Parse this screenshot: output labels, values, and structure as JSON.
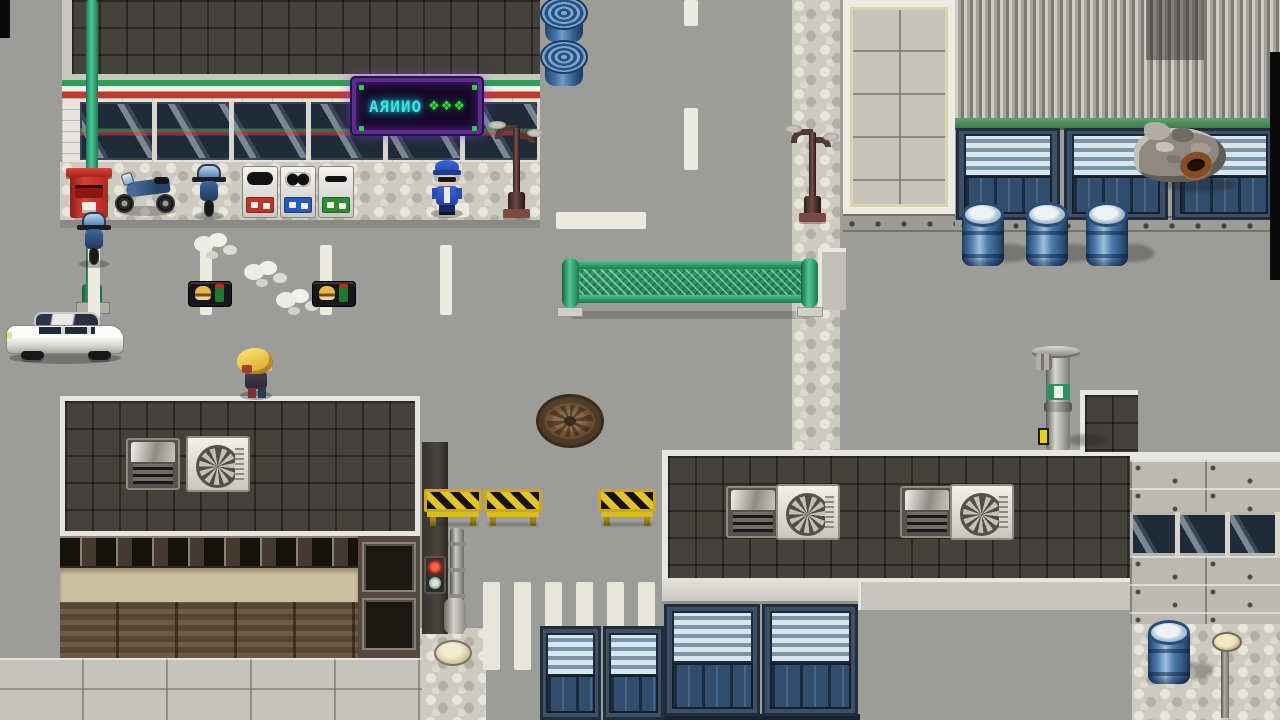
{
  "scene": {
    "label": "top-down city street with convenience store",
    "sign": {
      "text": "ONNRA",
      "symbols": "❖❖❖"
    }
  },
  "colors": {
    "road": "#9c9c98",
    "store_roof": "#45413d",
    "frame_light": "#e6e4de",
    "awning_green": "#2f9e57",
    "awning_red": "#c0392f",
    "brick_wall": "#e6e3dc",
    "window_glass": "#1f2b38",
    "neon_frame": "#5b2e8e",
    "neon_text": "#3ae4e4",
    "neon_symbols": "#34d83a",
    "pavement": "#cdcac2",
    "mailbox_red": "#c8322b",
    "motorcycle_blue": "#3a5a8a",
    "officer_blue": "#2d5ac8",
    "player_hair": "#e8c44a",
    "car_white": "#e9e9e7",
    "fence_green": "#2f9e6a",
    "manhole_brown": "#75583c",
    "hazard_yellow": "#e3c42c",
    "barrel_blue": "#4a7aae",
    "container_blue": "#3c5068",
    "louver_light": "#d8e6ee",
    "corrugated_gray": "#a4a29c",
    "tile_wall": "#c6c3bb",
    "concrete": "#bcb9b2",
    "planks_brown": "#5a4836",
    "tan_band": "#cfc0a2",
    "crosswalk_white": "#e8e6da",
    "trim_green": "#4a8a5a",
    "signal_red": "#d82818"
  },
  "sprites": [
    {
      "t": "vdash",
      "n": "lane-dash",
      "x": 88,
      "y": 248
    },
    {
      "t": "vdash",
      "n": "lane-dash",
      "x": 200,
      "y": 245
    },
    {
      "t": "vdash",
      "n": "lane-dash",
      "x": 320,
      "y": 245
    },
    {
      "t": "vdash",
      "n": "lane-dash",
      "x": 440,
      "y": 245
    },
    {
      "t": "hdash",
      "n": "stop-line",
      "x": 556,
      "y": 212,
      "w": 90,
      "h": 17
    },
    {
      "t": "hdash",
      "n": "road-mark",
      "x": 437,
      "y": 203,
      "w": 32,
      "h": 14
    },
    {
      "t": "hdash",
      "n": "center-line-dash",
      "x": 684,
      "y": 0,
      "w": 14,
      "h": 26
    },
    {
      "t": "hdash",
      "n": "center-line-dash",
      "x": 684,
      "y": 108,
      "w": 14,
      "h": 62
    },
    {
      "t": "cross",
      "n": "crosswalk-stripe",
      "x": 483,
      "y": 582
    },
    {
      "t": "cross",
      "n": "crosswalk-stripe",
      "x": 514,
      "y": 582
    },
    {
      "t": "cross",
      "n": "crosswalk-stripe",
      "x": 545,
      "y": 582
    },
    {
      "t": "cross",
      "n": "crosswalk-stripe",
      "x": 576,
      "y": 582
    },
    {
      "t": "cross",
      "n": "crosswalk-stripe",
      "x": 607,
      "y": 582
    },
    {
      "t": "cross",
      "n": "crosswalk-stripe",
      "x": 638,
      "y": 582
    },
    {
      "t": "unit",
      "n": "shutter-container",
      "x": 956,
      "y": 128,
      "w": 104,
      "h": 92
    },
    {
      "t": "unit",
      "n": "shutter-container",
      "x": 1064,
      "y": 128,
      "w": 104,
      "h": 92
    },
    {
      "t": "unit",
      "n": "shutter-container",
      "x": 1172,
      "y": 128,
      "w": 104,
      "h": 92
    },
    {
      "t": "unit",
      "n": "shutter-container",
      "x": 664,
      "y": 604,
      "w": 96,
      "h": 112
    },
    {
      "t": "unit",
      "n": "shutter-container",
      "x": 762,
      "y": 604,
      "w": 96,
      "h": 112
    },
    {
      "t": "unit",
      "n": "shutter-container",
      "x": 540,
      "y": 626,
      "w": 61,
      "h": 94
    },
    {
      "t": "unit",
      "n": "shutter-container",
      "x": 603,
      "y": 626,
      "w": 61,
      "h": 94
    },
    {
      "t": "smoke",
      "n": "dust-puff",
      "x": 194,
      "y": 232
    },
    {
      "t": "smoke",
      "n": "dust-puff",
      "x": 244,
      "y": 260
    },
    {
      "t": "smoke",
      "n": "dust-puff",
      "x": 276,
      "y": 288
    },
    {
      "t": "tray",
      "n": "food-tray",
      "x": 188,
      "y": 281,
      "i": true
    },
    {
      "t": "tray",
      "n": "food-tray",
      "x": 312,
      "y": 281,
      "i": true
    },
    {
      "t": "bin",
      "n": "recycle-bin-burnable",
      "x": 242,
      "y": 166,
      "i": true
    },
    {
      "t": "bin",
      "cls": "holes b",
      "n": "recycle-bin-cans",
      "x": 280,
      "y": 166,
      "i": true
    },
    {
      "t": "bin",
      "cls": "slot g",
      "n": "recycle-bin-bottles",
      "x": 318,
      "y": 166,
      "i": true
    },
    {
      "t": "coil",
      "n": "blue-hose-coil",
      "x": 540,
      "y": -4,
      "i": true
    },
    {
      "t": "coil",
      "n": "blue-hose-coil",
      "x": 540,
      "y": 40,
      "i": true
    },
    {
      "t": "eshadow",
      "n": "shadow",
      "x": 988,
      "y": 244,
      "w": 42,
      "h": 18
    },
    {
      "t": "eshadow",
      "n": "shadow",
      "x": 1052,
      "y": 244,
      "w": 42,
      "h": 18
    },
    {
      "t": "eshadow",
      "n": "shadow",
      "x": 1112,
      "y": 244,
      "w": 42,
      "h": 18
    },
    {
      "t": "eshadow",
      "n": "shadow",
      "x": 1178,
      "y": 662,
      "w": 36,
      "h": 16
    },
    {
      "t": "eshadow",
      "n": "shadow",
      "x": 1068,
      "y": 434,
      "w": 38,
      "h": 12
    },
    {
      "t": "eshadow",
      "n": "shadow",
      "x": 1164,
      "y": 178,
      "w": 72,
      "h": 14
    },
    {
      "t": "barrel",
      "n": "blue-drum",
      "x": 962,
      "y": 210,
      "i": true
    },
    {
      "t": "barrel",
      "n": "blue-drum",
      "x": 1026,
      "y": 210,
      "i": true
    },
    {
      "t": "barrel",
      "n": "blue-drum",
      "x": 1086,
      "y": 210,
      "i": true
    },
    {
      "t": "barrel",
      "n": "blue-drum",
      "x": 1148,
      "y": 628,
      "i": true
    },
    {
      "t": "junk",
      "n": "junk-pile",
      "x": 1130,
      "y": 120,
      "i": true
    },
    {
      "t": "junkring",
      "n": "rusty-tire",
      "x": 1180,
      "y": 152,
      "i": true
    },
    {
      "t": "barricade",
      "n": "hazard-barricade",
      "x": 424,
      "y": 486,
      "i": true
    },
    {
      "t": "barricade",
      "n": "hazard-barricade",
      "x": 484,
      "y": 486,
      "i": true
    },
    {
      "t": "barricade",
      "n": "hazard-barricade",
      "x": 598,
      "y": 486,
      "i": true
    },
    {
      "t": "manhole",
      "n": "manhole-cover",
      "x": 536,
      "y": 394,
      "i": true
    },
    {
      "t": "acvent",
      "n": "rooftop-vent-unit",
      "x": 126,
      "y": 438
    },
    {
      "t": "accond",
      "n": "ac-condenser",
      "x": 186,
      "y": 436
    },
    {
      "t": "acvent",
      "n": "rooftop-vent-unit",
      "x": 726,
      "y": 486
    },
    {
      "t": "accond",
      "n": "ac-condenser",
      "x": 776,
      "y": 484
    },
    {
      "t": "acvent",
      "n": "rooftop-vent-unit",
      "x": 900,
      "y": 486
    },
    {
      "t": "accond",
      "n": "ac-condenser",
      "x": 950,
      "y": 484
    },
    {
      "t": "tlight",
      "n": "pedestrian-signal",
      "x": 424,
      "y": 556
    },
    {
      "t": "dome",
      "n": "ground-lamp",
      "x": 434,
      "y": 640
    },
    {
      "t": "bollard",
      "n": "street-bollard-lamp",
      "x": 1210,
      "y": 632
    },
    {
      "t": "black",
      "n": "screen-edge",
      "x": 0,
      "y": 0,
      "w": 10,
      "h": 38
    },
    {
      "t": "black",
      "n": "screen-edge",
      "x": 1270,
      "y": 52,
      "w": 10,
      "h": 228
    }
  ]
}
